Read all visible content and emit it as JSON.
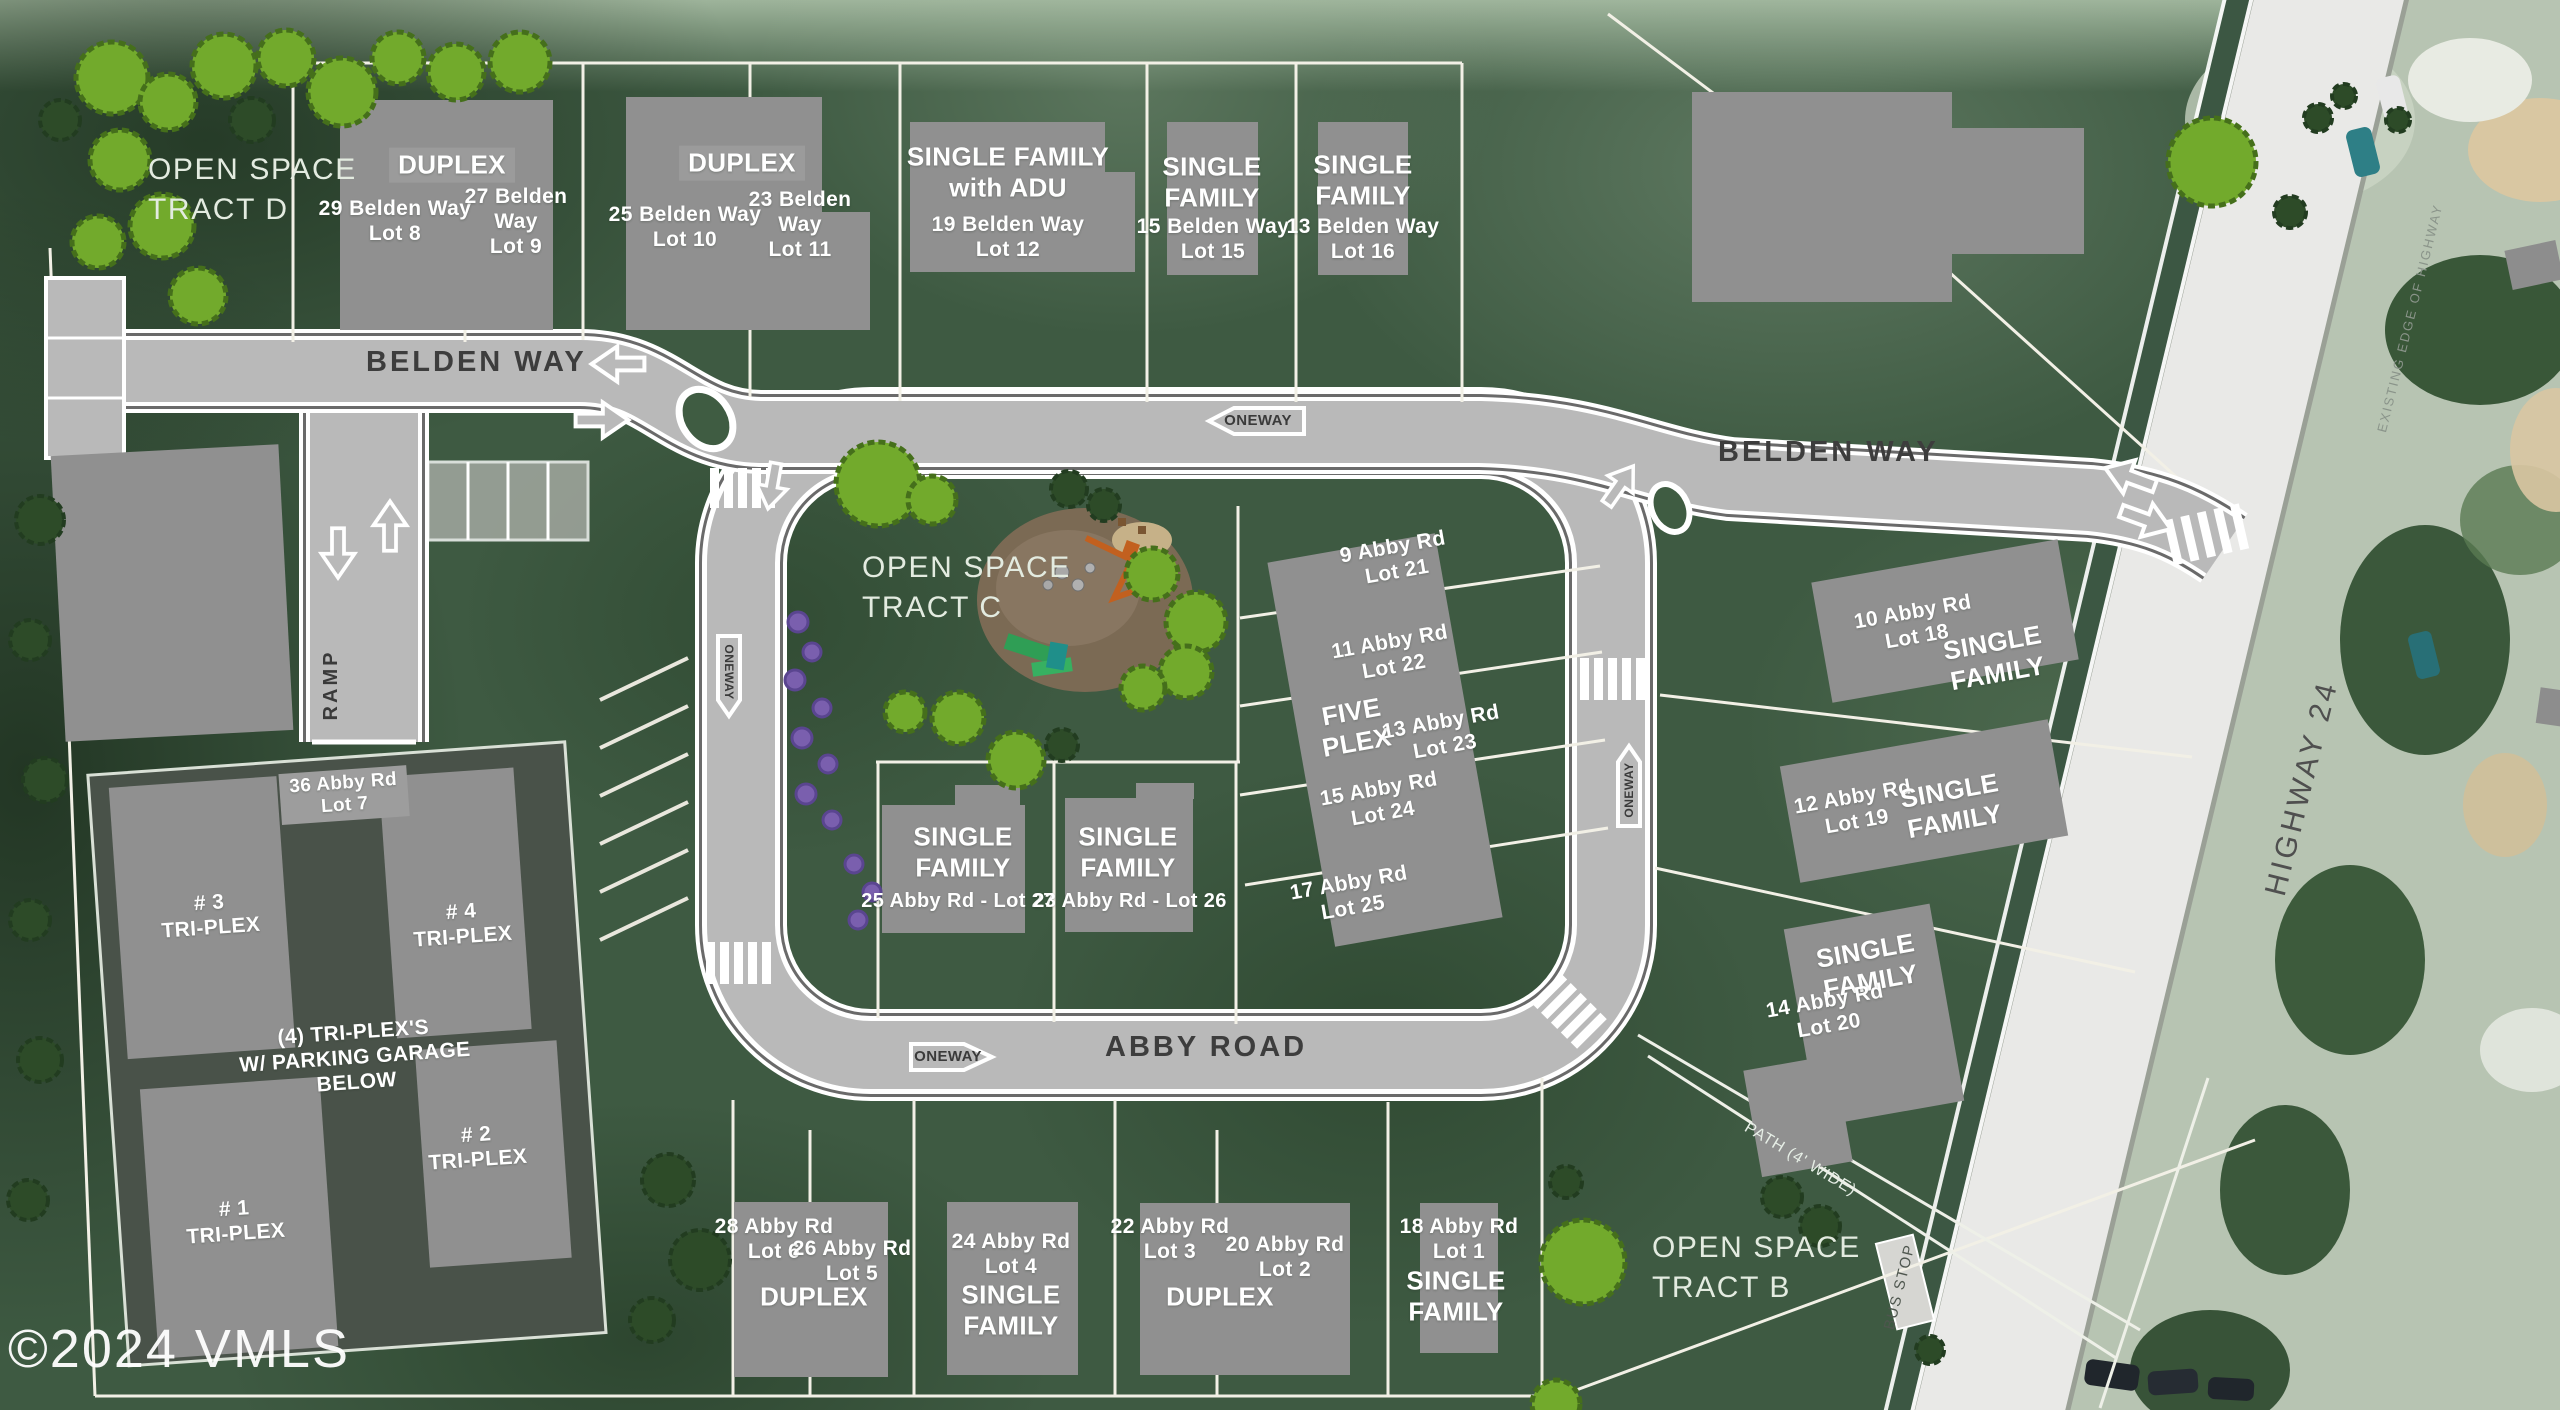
{
  "watermark": "©2024 VMLS",
  "roads": {
    "belden_west": "BELDEN WAY",
    "belden_east": "BELDEN WAY",
    "abby": "ABBY ROAD",
    "highway": "HIGHWAY 24",
    "highway_edge": "EXISTING EDGE OF HIGHWAY",
    "ramp": "RAMP",
    "oneway_top": "ONEWAY",
    "oneway_abby": "ONEWAY",
    "oneway_loop_west": "ONEWAY",
    "oneway_loop_east": "ONEWAY",
    "bus_stop": "BUS STOP",
    "path": "PATH (4' WIDE)"
  },
  "open_space": {
    "d1": "OPEN SPACE",
    "d2": "TRACT D",
    "c1": "OPEN SPACE",
    "c2": "TRACT C",
    "b1": "OPEN SPACE",
    "b2": "TRACT B"
  },
  "top_lots": {
    "duplex1_label": "DUPLEX",
    "lot8": {
      "addr": "29 Belden Way",
      "num": "Lot 8"
    },
    "lot9": {
      "addr": "27 Belden Way",
      "num": "Lot 9"
    },
    "duplex2_label": "DUPLEX",
    "lot10": {
      "addr": "25 Belden Way",
      "num": "Lot 10"
    },
    "lot11": {
      "addr": "23 Belden Way",
      "num": "Lot 11"
    },
    "lot12": {
      "t1": "SINGLE FAMILY",
      "t2": "with ADU",
      "addr": "19 Belden Way",
      "num": "Lot 12"
    },
    "lot15": {
      "t1": "SINGLE",
      "t2": "FAMILY",
      "addr": "15 Belden Way",
      "num": "Lot 15"
    },
    "lot16": {
      "t1": "SINGLE",
      "t2": "FAMILY",
      "addr": "13 Belden Way",
      "num": "Lot 16"
    }
  },
  "fiveplex": {
    "t1": "FIVE",
    "t2": "PLEX",
    "lot21": {
      "addr": "9 Abby Rd",
      "num": "Lot 21"
    },
    "lot22": {
      "addr": "11 Abby Rd",
      "num": "Lot 22"
    },
    "lot23": {
      "addr": "13 Abby Rd",
      "num": "Lot 23"
    },
    "lot24": {
      "addr": "15 Abby Rd",
      "num": "Lot 24"
    },
    "lot25": {
      "addr": "17 Abby Rd",
      "num": "Lot 25"
    }
  },
  "inner_lots": {
    "lot27": {
      "t1": "SINGLE",
      "t2": "FAMILY",
      "addr": "25 Abby Rd - Lot 27"
    },
    "lot26": {
      "t1": "SINGLE",
      "t2": "FAMILY",
      "addr": "23 Abby Rd - Lot 26"
    }
  },
  "right_lots": {
    "lot18": {
      "addr": "10 Abby Rd",
      "num": "Lot 18",
      "t1": "SINGLE",
      "t2": "FAMILY"
    },
    "lot19": {
      "addr": "12 Abby Rd",
      "num": "Lot 19",
      "t1": "SINGLE",
      "t2": "FAMILY"
    },
    "lot20": {
      "addr": "14 Abby Rd",
      "num": "Lot 20",
      "t1": "SINGLE",
      "t2": "FAMILY"
    }
  },
  "triplex": {
    "lot7": {
      "addr": "36 Abby Rd",
      "num": "Lot 7"
    },
    "b1a": "# 1",
    "b1b": "TRI-PLEX",
    "b2a": "# 2",
    "b2b": "TRI-PLEX",
    "b3a": "# 3",
    "b3b": "TRI-PLEX",
    "b4a": "# 4",
    "b4b": "TRI-PLEX",
    "note1": "(4) TRI-PLEX'S",
    "note2": "W/ PARKING GARAGE",
    "note3": "BELOW"
  },
  "bottom_lots": {
    "duplex65_label": "DUPLEX",
    "lot6": {
      "addr": "28 Abby Rd",
      "num": "Lot 6"
    },
    "lot5": {
      "addr": "26 Abby Rd",
      "num": "Lot 5"
    },
    "lot4": {
      "addr": "24 Abby Rd",
      "num": "Lot 4",
      "t1": "SINGLE",
      "t2": "FAMILY"
    },
    "duplex32_label": "DUPLEX",
    "lot3": {
      "addr": "22 Abby Rd",
      "num": "Lot 3"
    },
    "lot2": {
      "addr": "20 Abby Rd",
      "num": "Lot 2"
    },
    "lot1": {
      "addr": "18 Abby Rd",
      "num": "Lot 1",
      "t1": "SINGLE",
      "t2": "FAMILY"
    }
  },
  "colors": {
    "grass": "#3e5a42",
    "road": "#b9b9b9",
    "highway": "#e9e9e7",
    "building": "#909090",
    "tree": "#72aa2c",
    "bush": "#7a5fae",
    "garage_parcel": "#495249",
    "lot_line": "#f2f0e6"
  }
}
